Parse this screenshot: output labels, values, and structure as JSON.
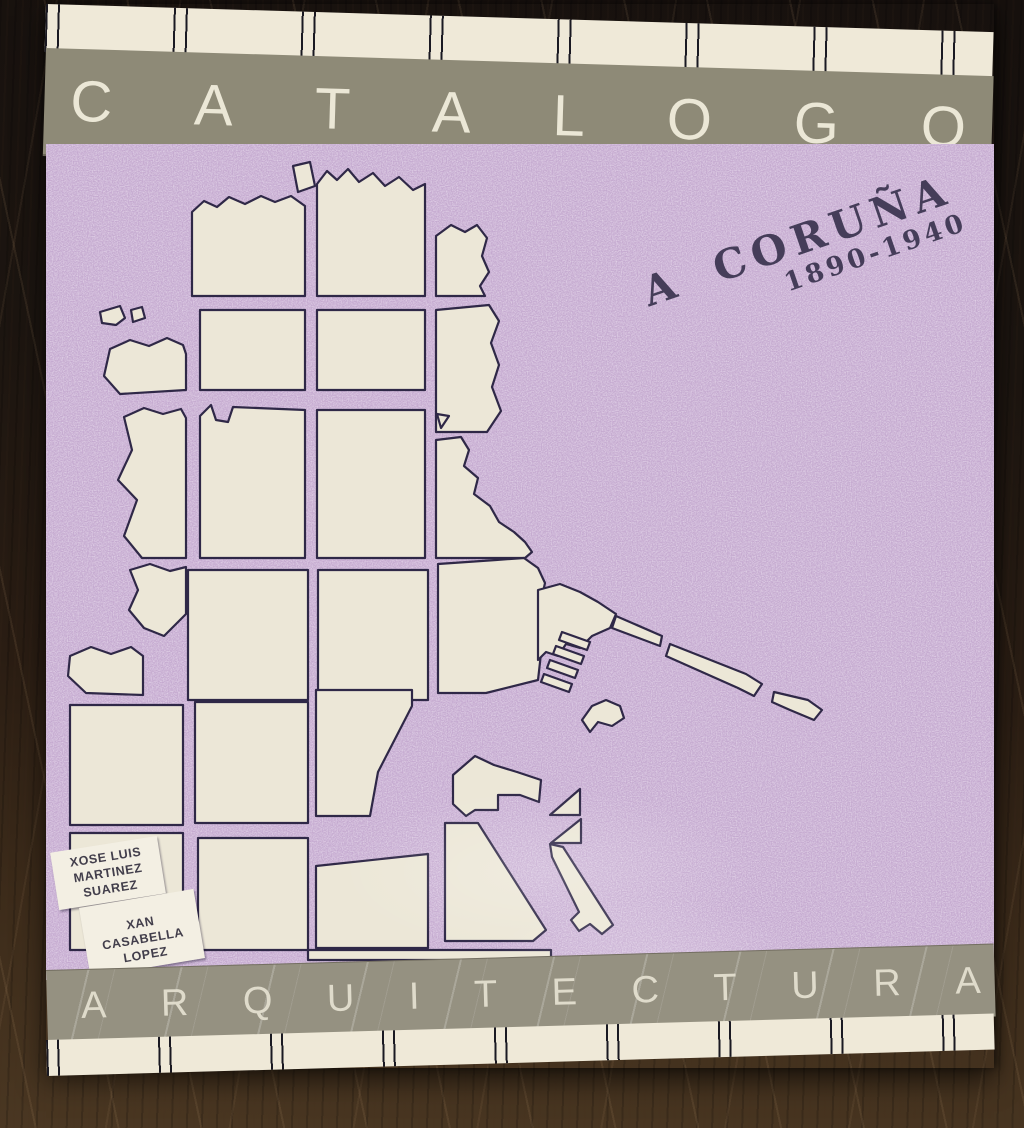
{
  "scene": {
    "description": "Photograph of an architecture catalogue book cover lying on a dark wooden table"
  },
  "banners": {
    "top": "CATALOGO",
    "bottom": "ARQUITECTURA"
  },
  "title": {
    "place": "A CORUÑA",
    "years": "1890-1940"
  },
  "authors": [
    {
      "lines": [
        "XOSE LUIS",
        "MARTINEZ",
        "SUAREZ"
      ]
    },
    {
      "lines": [
        "XAN",
        "CASABELLA",
        "LOPEZ"
      ]
    }
  ],
  "map": {
    "subject": "street-grid map of the A Coruña peninsula with harbor breakwater"
  },
  "colors": {
    "purple_base": "#c5aacf",
    "band_gray": "#8e8a77",
    "band_gray_2": "#959181",
    "strip_cream": "#efe9d8",
    "map_cream": "#ece7d7",
    "map_ink": "#2f2847",
    "letter_cream": "#ebe7d6",
    "title_ink": "#453d59",
    "label_ink": "#423e4b",
    "card_white": "#f3efe3",
    "wood_dark": "#17110e",
    "wood_mid": "#2a1d13",
    "wood_light": "#4a3722"
  }
}
